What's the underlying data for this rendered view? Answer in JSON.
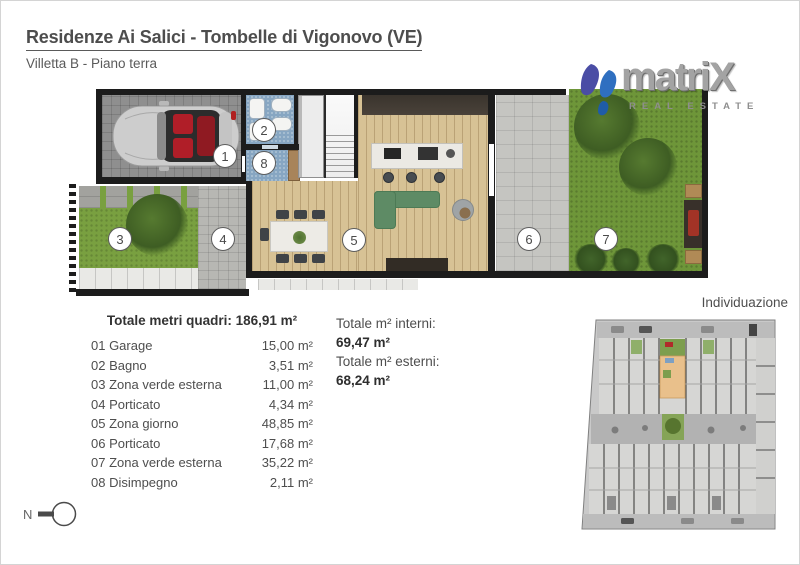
{
  "page": {
    "title": "Residenze Ai Salici - Tombelle di Vigonovo (VE)",
    "subtitle": "Villetta B - Piano terra"
  },
  "logo": {
    "brand": "matriX",
    "tagline": "REAL ESTATE"
  },
  "floorplan": {
    "markers": [
      "1",
      "2",
      "3",
      "4",
      "5",
      "6",
      "7",
      "8"
    ],
    "legend": {
      "1": "Garage",
      "2": "Bagno",
      "3": "Zona verde esterna",
      "4": "Porticato",
      "5": "Zona giorno",
      "6": "Porticato",
      "7": "Zona verde esterna",
      "8": "Disimpegno"
    }
  },
  "areas": {
    "header": "Totale metri quadri: 186,91 m²",
    "rows": [
      {
        "label": "01 Garage",
        "value": "15,00 m²"
      },
      {
        "label": "02 Bagno",
        "value": "3,51 m²"
      },
      {
        "label": "03 Zona verde esterna",
        "value": "11,00 m²"
      },
      {
        "label": "04 Porticato",
        "value": "4,34 m²"
      },
      {
        "label": "05 Zona giorno",
        "value": "48,85 m²"
      },
      {
        "label": "06 Porticato",
        "value": "17,68 m²"
      },
      {
        "label": "07 Zona verde esterna",
        "value": "35,22 m²"
      },
      {
        "label": "08 Disimpegno",
        "value": "2,11 m²"
      }
    ]
  },
  "totals": {
    "interni_label": "Totale m² interni:",
    "interni_value": "69,47 m²",
    "esterni_label": "Totale m² esterni:",
    "esterni_value": "68,24 m²"
  },
  "siteplan": {
    "title": "Individuazione"
  },
  "compass": {
    "label": "N"
  },
  "colors": {
    "text": "#4a4a4a",
    "wall": "#1c1c1c",
    "wood_floor": "#d7c295",
    "grass": "#79a040",
    "bath_tile": "#87a6c2",
    "stone": "#c5c5c1",
    "sofa_green": "#5e8b65",
    "highlight_unit": "#e9c08b",
    "logo_purple": "#4a4da5",
    "logo_blue": "#2f6fc0"
  }
}
